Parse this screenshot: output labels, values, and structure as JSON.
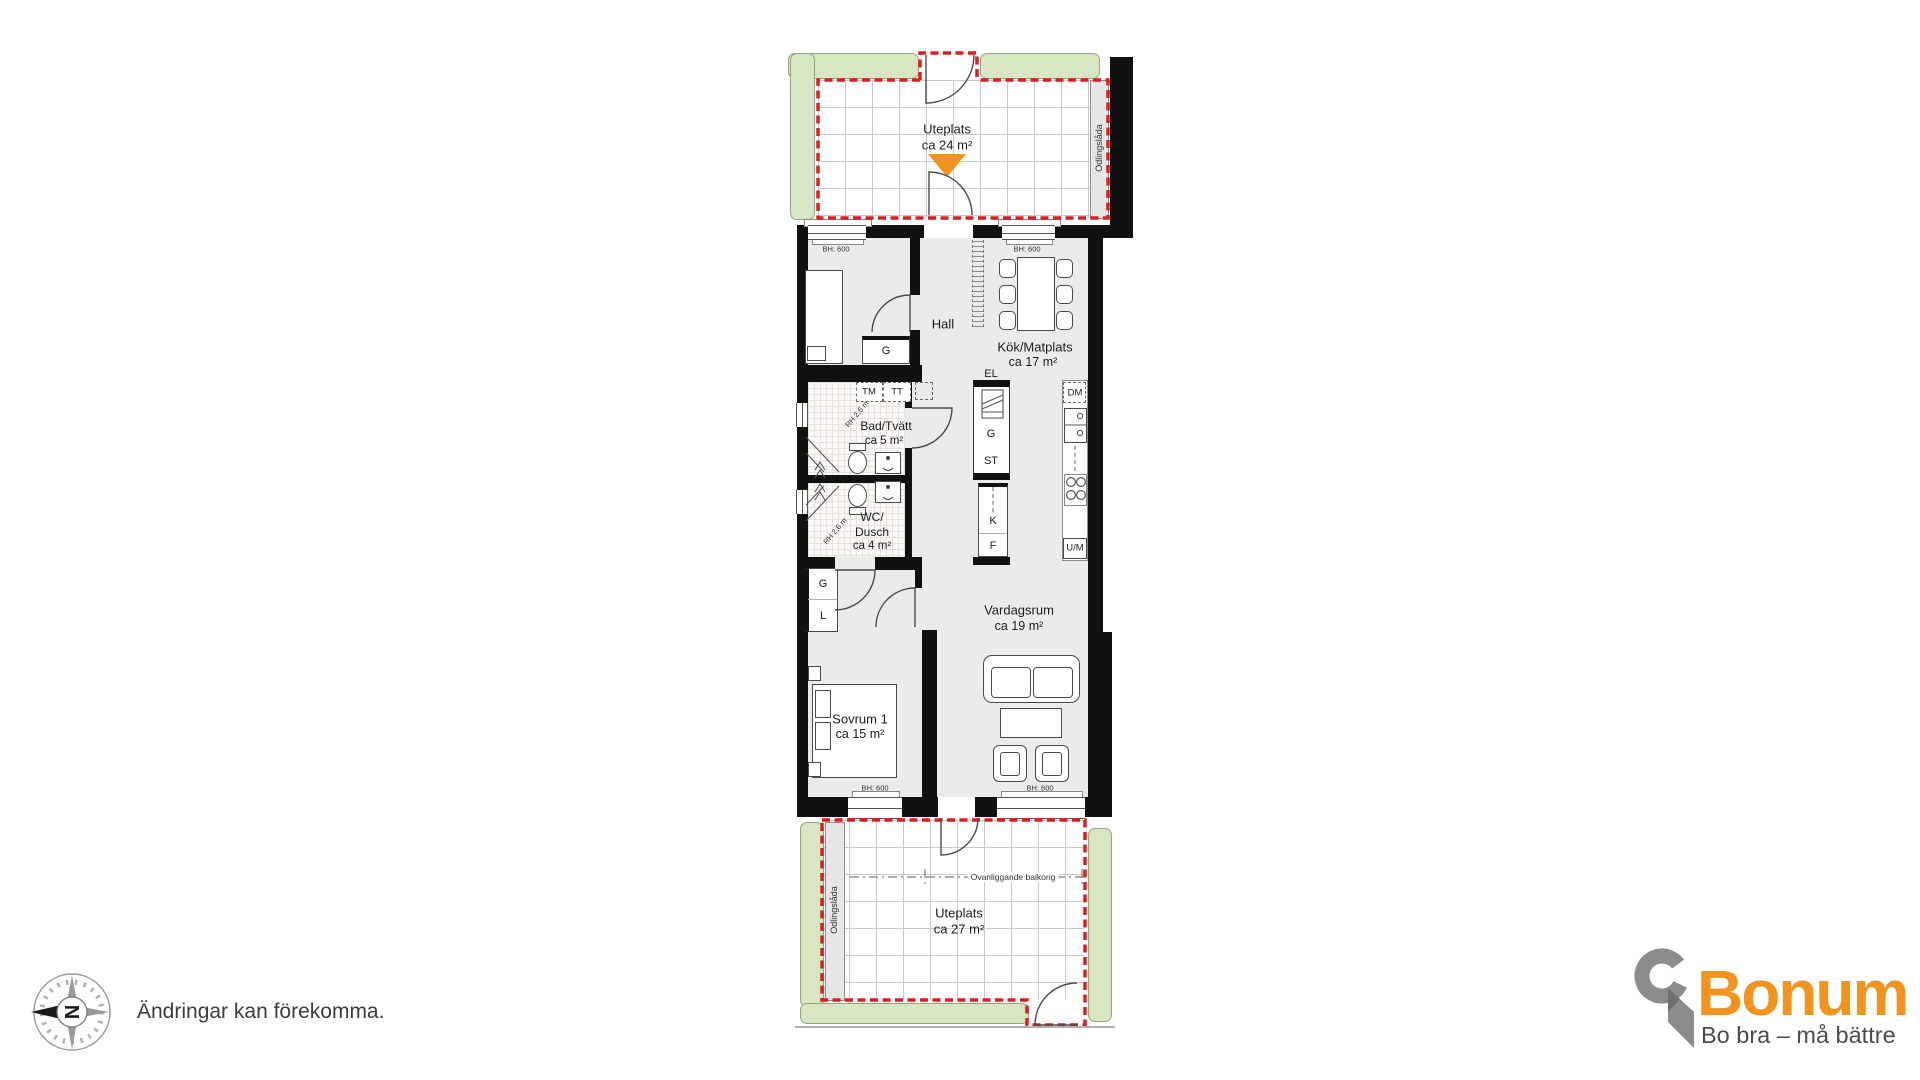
{
  "colors": {
    "boundary_red": "#E01B24",
    "hedge_green": "#D8E6C4",
    "accent_orange": "#F0931F",
    "brand_orange": "#F0931F",
    "brand_gray": "#8C8C8C",
    "wall_black": "#111111",
    "floor_gray": "#EBEBEB"
  },
  "plan": {
    "bh_label": "BH: 600",
    "terrace_top": {
      "label": "Uteplats",
      "area": "ca 24 m²",
      "planter": "Odlingslåda"
    },
    "terrace_bottom": {
      "label": "Uteplats",
      "area": "ca 27 m²",
      "planter": "Odlingslåda",
      "balcony_note": "Ovanliggande balkong"
    },
    "rooms": {
      "sovrum2": {
        "label": "Sovrum 2",
        "area": "ca 7 m²"
      },
      "hall": {
        "label": "Hall"
      },
      "kok": {
        "label": "Kök/Matplats",
        "area": "ca 17 m²"
      },
      "bad": {
        "label": "Bad/Tvätt",
        "area": "ca 5 m²",
        "ceiling": "RH 2,6 m"
      },
      "wc": {
        "label_line1": "WC/",
        "label_line2": "Dusch",
        "area": "ca 4 m²",
        "ceiling": "RH 2,6 m"
      },
      "vardagsrum": {
        "label": "Vardagsrum",
        "area": "ca 19 m²"
      },
      "sovrum1": {
        "label": "Sovrum 1",
        "area": "ca 15 m²"
      }
    },
    "fixtures": {
      "washer": "TM",
      "dryer": "TT",
      "electrical": "EL",
      "wardrobe": "G",
      "cleaning": "ST",
      "fridge": "K",
      "freezer": "F",
      "dishwasher": "DM",
      "oven_micro": "U/M",
      "hall_wardrobe": "G",
      "linen": "L",
      "bedroom_wardrobe": "G"
    }
  },
  "footer": {
    "disclaimer": "Ändringar kan förekomma.",
    "compass_letter": "N"
  },
  "brand": {
    "name": "Bonum",
    "tagline": "Bo bra – må bättre"
  }
}
